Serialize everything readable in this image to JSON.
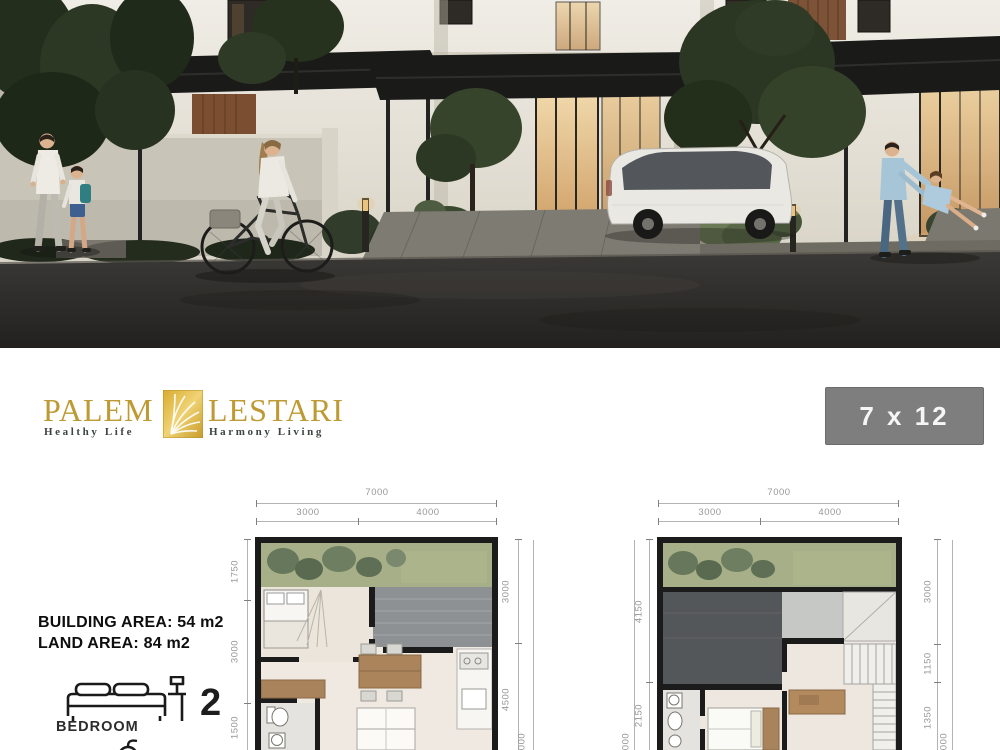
{
  "brand": {
    "name_left": "PALEM",
    "name_right": "LESTARI",
    "tagline_left": "Healthy Life",
    "tagline_right": "Harmony Living"
  },
  "badge": {
    "label": "7 x 12"
  },
  "specs": {
    "building_area": "BUILDING AREA: 54 m2",
    "land_area": "LAND AREA: 84 m2"
  },
  "features": {
    "bedroom_count": "2",
    "bedroom_label": "BEDROOM"
  },
  "plans": {
    "left": {
      "top_total": "7000",
      "top_segments": [
        "3000",
        "4000"
      ],
      "left_dims": [
        "1750",
        "3000",
        "1500"
      ],
      "right_dims": [
        "3000",
        "4500"
      ],
      "right_outer_partial": "000"
    },
    "right": {
      "top_total": "7000",
      "top_segments": [
        "3000",
        "4000"
      ],
      "left_dims": [
        "4150",
        "2150"
      ],
      "left_outer_partial": "000",
      "right_dims": [
        "3000",
        "1150",
        "1350"
      ],
      "right_outer_partial": "000"
    }
  },
  "colors": {
    "logo_gold": "#bf9b30",
    "tagline_green": "#3e453f",
    "badge_gray": "#7e7e7e",
    "plan_wall": "#1b1b1b",
    "garden_green": "#a6af87",
    "carport_gray": "#8e9193",
    "road_dark": "#2b2926"
  }
}
